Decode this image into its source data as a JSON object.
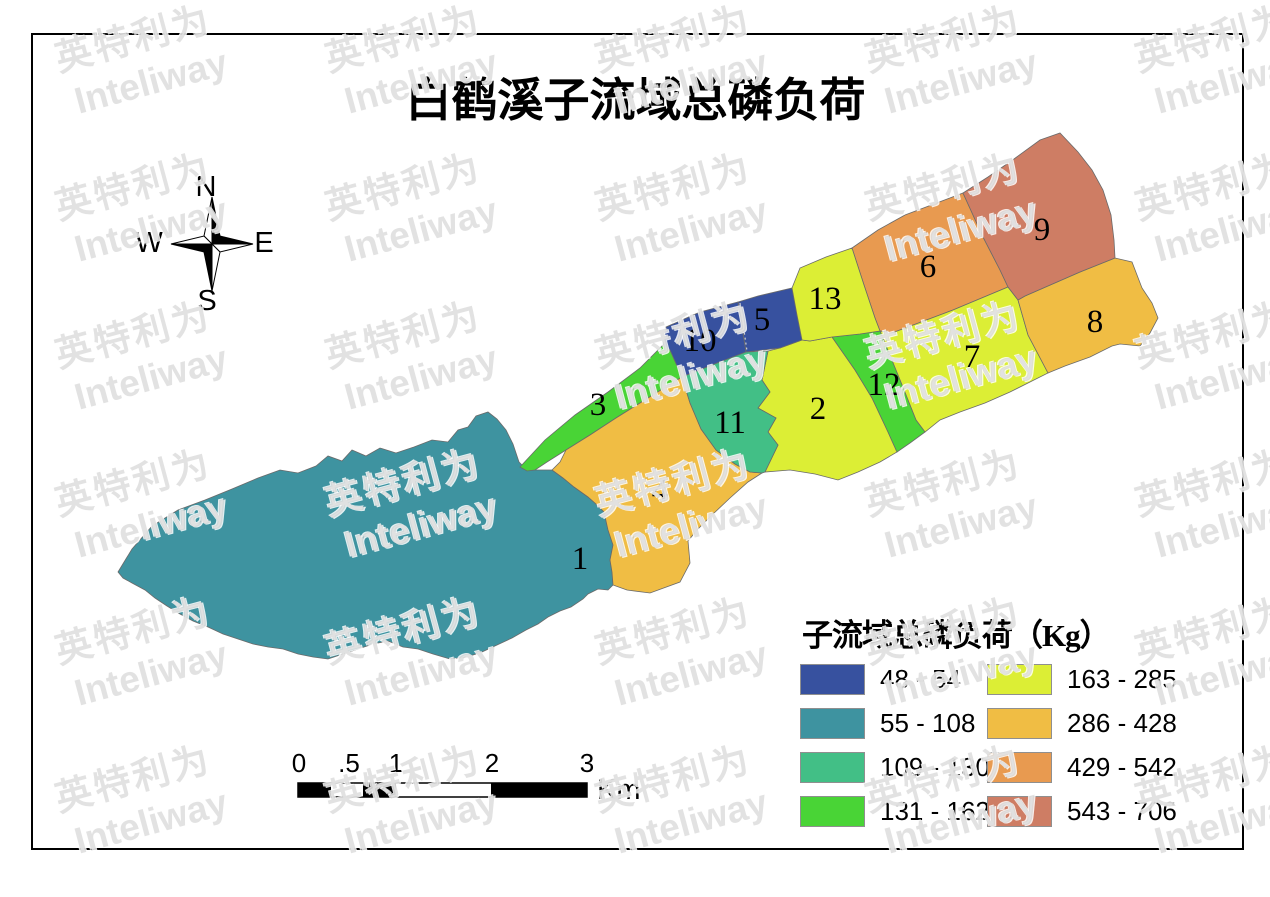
{
  "title": "白鹤溪子流域总磷负荷",
  "compass": {
    "north": "N",
    "east": "E",
    "south": "S",
    "west": "W"
  },
  "legend": {
    "title": "子流域总磷负荷（Kg）",
    "items": [
      {
        "range": "48 - 54",
        "color": "#37519F"
      },
      {
        "range": "55 - 108",
        "color": "#3E93A0"
      },
      {
        "range": "109 - 130",
        "color": "#42BF86"
      },
      {
        "range": "131 - 162",
        "color": "#49D436"
      },
      {
        "range": "163 - 285",
        "color": "#DCEE35"
      },
      {
        "range": "286 - 428",
        "color": "#F0BD44"
      },
      {
        "range": "429 - 542",
        "color": "#E89A50"
      },
      {
        "range": "543 - 706",
        "color": "#CE7D64"
      }
    ]
  },
  "scalebar": {
    "tick_labels": [
      "0",
      ".5",
      "1",
      "2",
      "3"
    ],
    "unit": "Km"
  },
  "watermark": {
    "line1": "英特利为",
    "line2": "Inteliway"
  },
  "map": {
    "zones": [
      {
        "id": "1",
        "load_kg_range": "55 - 108",
        "color": "#3E93A0",
        "label": {
          "x": 580,
          "y": 569
        },
        "points": "118,572 132,549 152,526 178,510 205,500 232,489 258,478 280,470 298,473 316,466 328,456 342,461 352,450 366,456 380,448 396,453 414,447 432,440 448,442 458,430 468,427 476,416 488,412 497,419 506,430 513,444 519,462 527,470 552,470 563,478 574,487 588,497 596,504 604,512 608,530 613,545 610,560 612,572 613,585 608,590 598,589 588,594 583,599 571,607 560,611 548,617 538,624 526,630 512,638 497,645 482,652 467,657 450,659 433,654 418,649 403,647 388,641 373,644 358,649 343,654 328,659 313,657 298,654 283,649 268,647 253,644 238,639 223,634 208,627 193,621 180,614 167,606 155,598 145,590 132,583 123,578"
      },
      {
        "id": "2",
        "load_kg_range": "163 - 285",
        "color": "#DCEE35",
        "label": {
          "x": 818,
          "y": 419
        },
        "points": "768,351 780,348 802,340 810,341 832,337 855,370 872,398 888,432 897,452 880,462 858,472 838,480 815,474 790,470 765,472 778,445 768,432 776,418 758,408 770,392 762,380"
      },
      {
        "id": "3",
        "load_kg_range": "131 - 162",
        "color": "#49D436",
        "label": {
          "x": 598,
          "y": 415
        },
        "points": "520,467 545,440 575,415 608,392 640,368 663,345 670,350 682,377 664,388 640,403 616,418 590,435 566,450 547,462 535,470 527,471"
      },
      {
        "id": "4",
        "load_kg_range": "286 - 428",
        "color": "#F0BD44",
        "label": {
          "x": 660,
          "y": 501
        },
        "points": "552,470 560,462 566,450 590,435 616,418 640,403 664,388 682,377 690,403 701,429 716,450 735,464 750,472 762,473 748,482 730,498 712,515 697,530 688,541 690,563 680,582 650,593 627,590 613,585 612,572 610,560 613,545 608,530 604,512 596,504 588,497 574,487 563,478"
      },
      {
        "id": "5",
        "load_kg_range": "48 - 54",
        "color": "#37519F",
        "label": {
          "x": 762,
          "y": 330
        },
        "points": "738,302 758,296 792,288 802,340 780,348 746,352"
      },
      {
        "id": "6",
        "load_kg_range": "429 - 542",
        "color": "#E89A50",
        "label": {
          "x": 928,
          "y": 277
        },
        "points": "852,248 878,230 905,215 934,204 963,193 983,237 1000,270 1008,287 953,310 892,333 880,331 875,318 864,285"
      },
      {
        "id": "7",
        "load_kg_range": "163 - 285",
        "color": "#DCEE35",
        "label": {
          "x": 972,
          "y": 367
        },
        "points": "880,331 892,333 953,310 1008,287 1018,300 1028,335 1048,373 1030,382 1010,392 985,403 960,412 940,420 925,432 916,420 900,380"
      },
      {
        "id": "8",
        "load_kg_range": "286 - 428",
        "color": "#F0BD44",
        "label": {
          "x": 1095,
          "y": 332
        },
        "points": "1018,300 1025,296 1080,272 1115,258 1132,262 1142,288 1152,303 1158,318 1150,333 1140,346 1120,344 1112,346 1090,357 1065,366 1048,373 1028,335"
      },
      {
        "id": "9",
        "load_kg_range": "543 - 706",
        "color": "#CE7D64",
        "label": {
          "x": 1042,
          "y": 240
        },
        "points": "963,193 988,177 1014,159 1040,140 1060,133 1078,152 1092,170 1103,190 1111,215 1114,240 1115,258 1080,272 1025,296 1018,300 1008,287 1000,270 983,237"
      },
      {
        "id": "10",
        "load_kg_range": "48 - 54",
        "color": "#37519F",
        "label": {
          "x": 700,
          "y": 351
        },
        "points": "666,327 700,312 738,302 746,352 712,365 682,377 670,350 663,345"
      },
      {
        "id": "11",
        "load_kg_range": "109 - 130",
        "color": "#42BF86",
        "label": {
          "x": 730,
          "y": 433
        },
        "points": "682,377 712,365 746,352 768,351 762,380 770,392 758,408 776,418 768,432 778,445 765,472 762,473 750,472 735,464 716,450 701,429 690,403"
      },
      {
        "id": "12",
        "load_kg_range": "131 - 162",
        "color": "#49D436",
        "label": {
          "x": 884,
          "y": 395
        },
        "points": "832,337 860,334 880,331 900,380 916,420 925,432 910,443 897,452 888,432 872,398 855,370"
      },
      {
        "id": "13",
        "load_kg_range": "163 - 285",
        "color": "#DCEE35",
        "label": {
          "x": 825,
          "y": 309
        },
        "points": "792,288 800,268 826,257 852,248 864,285 875,318 880,331 860,334 832,337 810,341 802,340 797,315"
      }
    ],
    "divider_line": {
      "x1": 740,
      "y1": 303,
      "x2": 747,
      "y2": 351
    }
  }
}
